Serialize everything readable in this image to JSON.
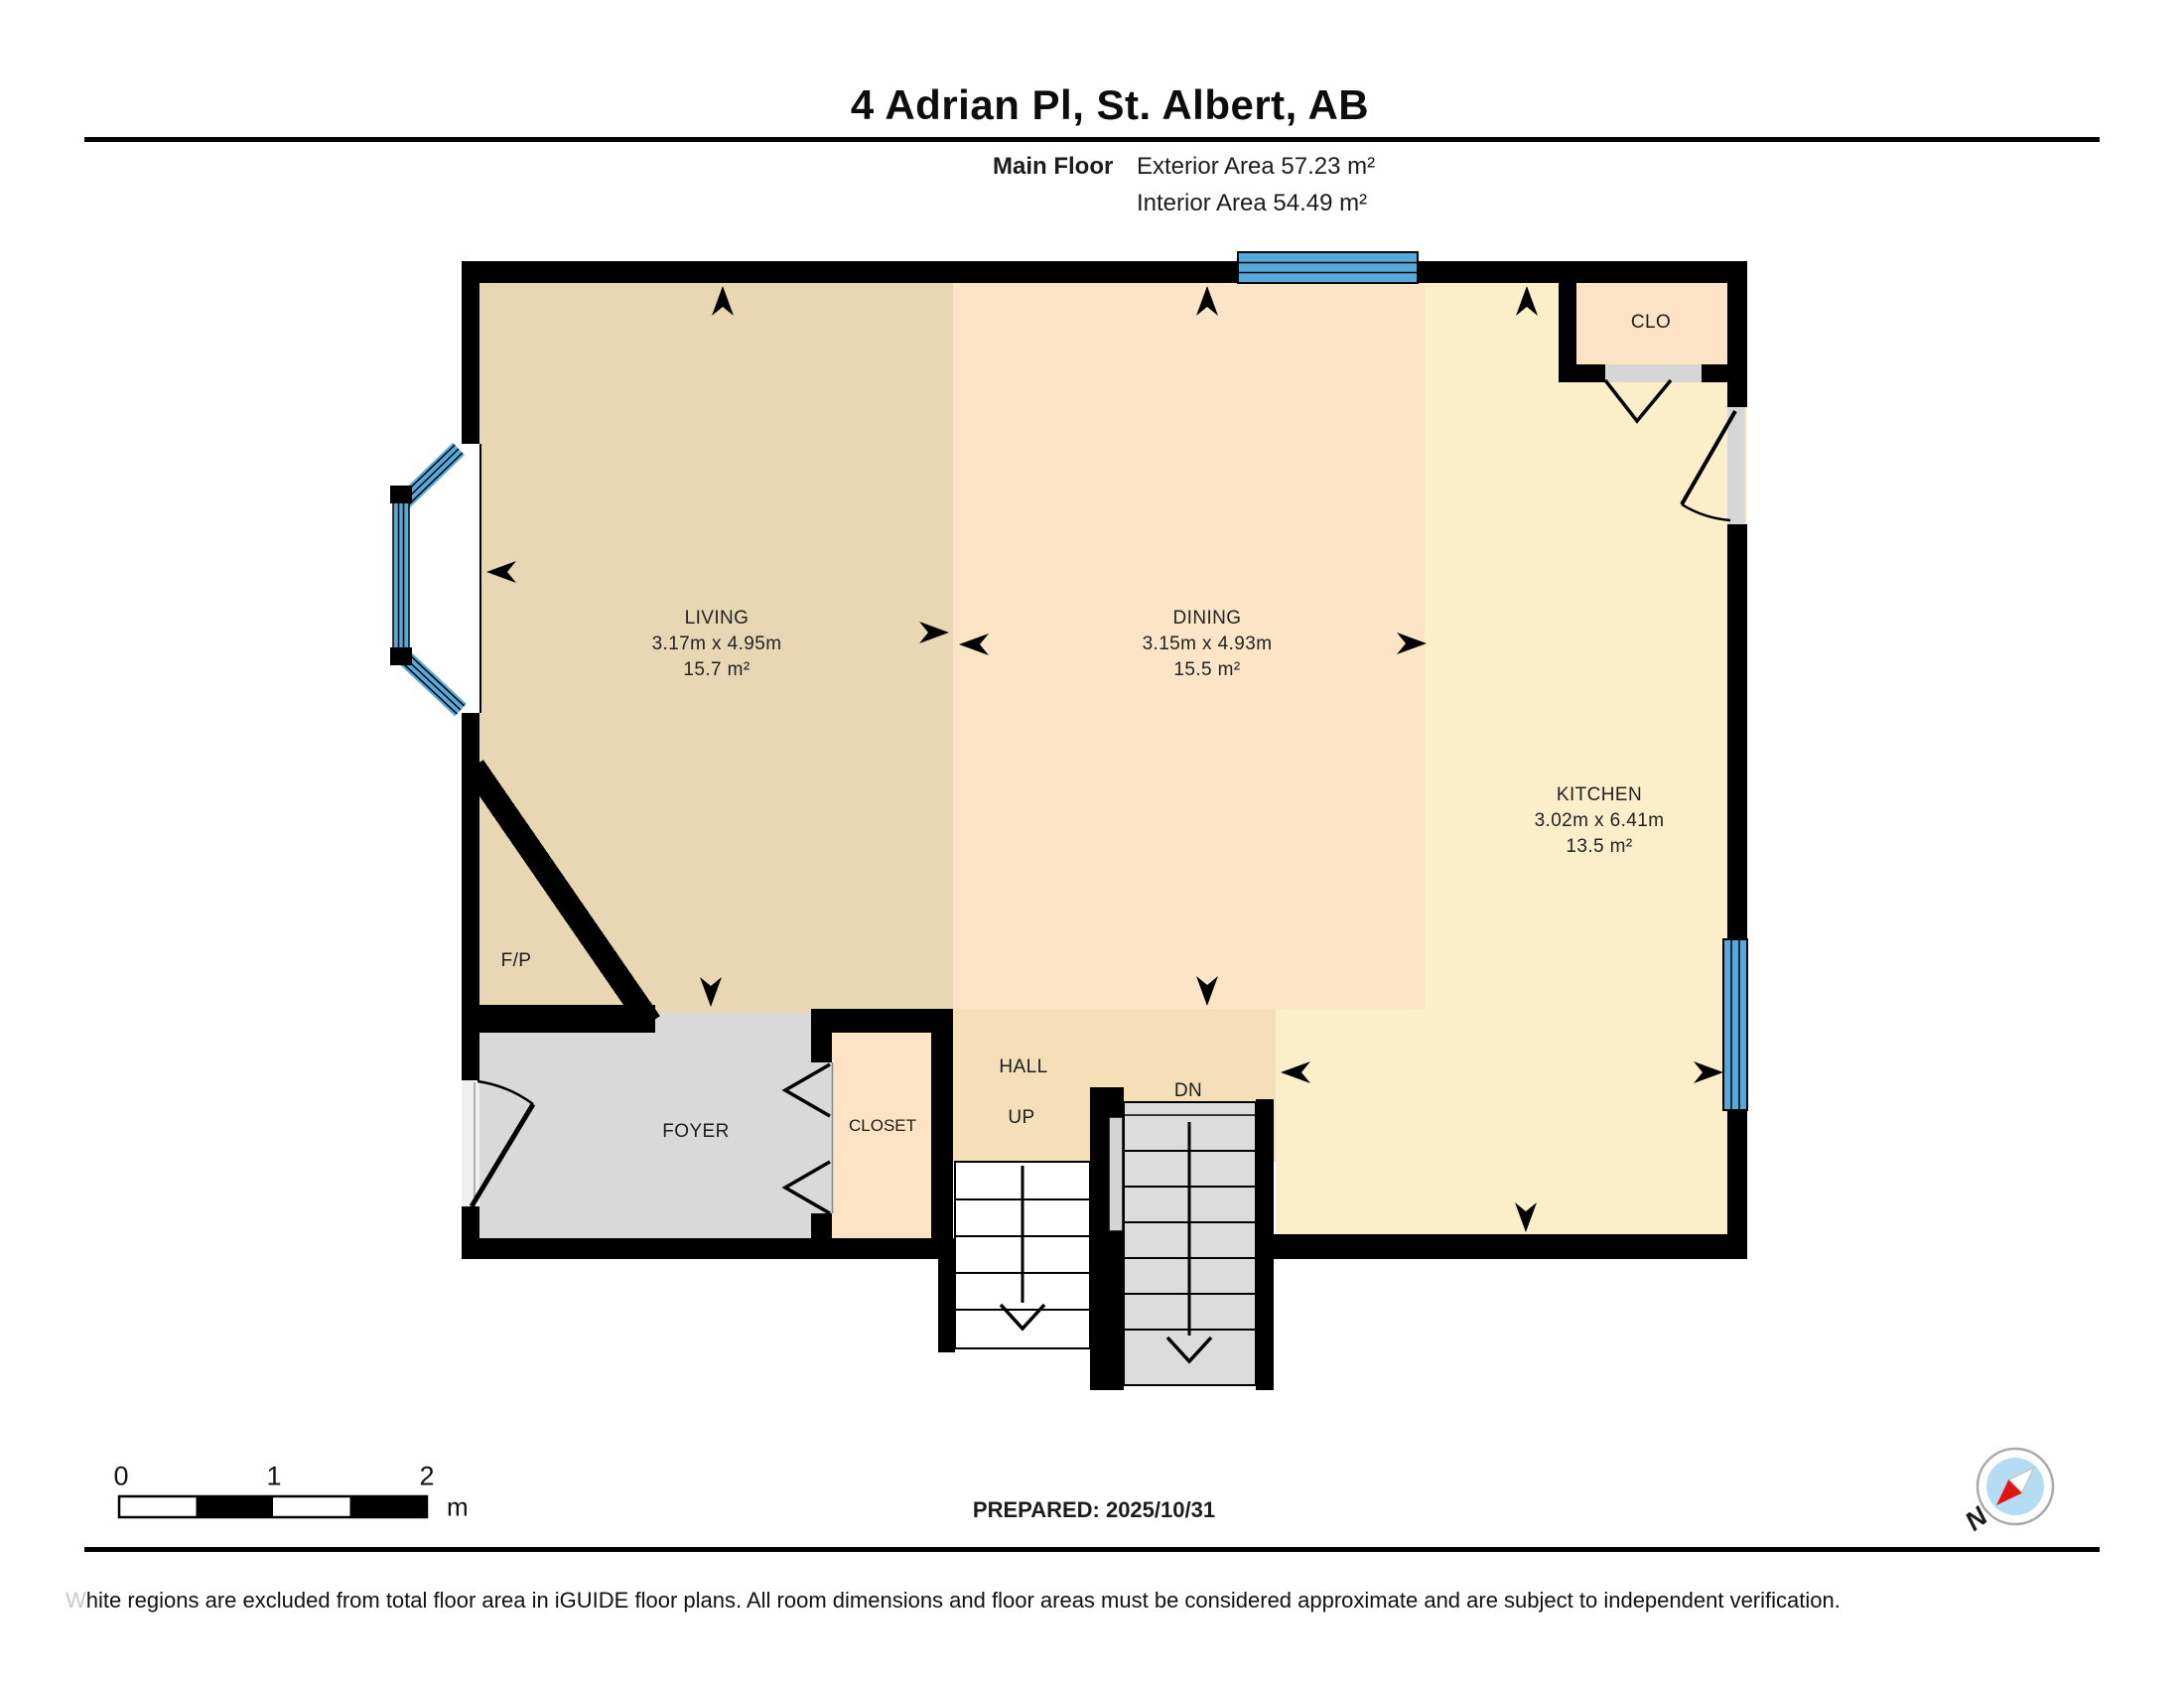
{
  "header": {
    "title": "4 Adrian Pl, St. Albert, AB",
    "floor_label": "Main Floor",
    "exterior_area": "Exterior Area 57.23 m²",
    "interior_area": "Interior Area 54.49 m²"
  },
  "rooms": {
    "living": {
      "name": "LIVING",
      "dimensions": "3.17m x 4.95m",
      "area": "15.7 m²"
    },
    "dining": {
      "name": "DINING",
      "dimensions": "3.15m x 4.93m",
      "area": "15.5 m²"
    },
    "kitchen": {
      "name": "KITCHEN",
      "dimensions": "3.02m x 6.41m",
      "area": "13.5 m²"
    },
    "clo": {
      "name": "CLO"
    },
    "fireplace": {
      "name": "F/P"
    },
    "foyer": {
      "name": "FOYER"
    },
    "closet": {
      "name": "CLOSET"
    },
    "hall": {
      "name": "HALL"
    },
    "stairs_up": {
      "name": "UP"
    },
    "stairs_down": {
      "name": "DN"
    }
  },
  "scale_bar": {
    "ticks": [
      "0",
      "1",
      "2"
    ],
    "unit": "m"
  },
  "compass": {
    "north_label": "N"
  },
  "footer": {
    "prepared": "PREPARED: 2025/10/31",
    "disclaimer_lead": "W",
    "disclaimer_rest": "hite regions are excluded from total floor area in iGUIDE floor plans. All room dimensions and floor areas must be considered approximate and are subject to independent verification."
  },
  "colors": {
    "wall": "#000000",
    "living": "#e9d6b2",
    "dining": "#fbe5c6",
    "kitchen": "#fdeeca",
    "hall": "#f4dfb8",
    "closet": "#fce3c6",
    "foyer": "#d9d9d9",
    "stair_gray": "#dcdcdc",
    "door_opening": "#d6d6d6",
    "window_blue": "#57a9d9",
    "compass_blue": "#b5dcf2",
    "compass_red": "#e41414"
  }
}
